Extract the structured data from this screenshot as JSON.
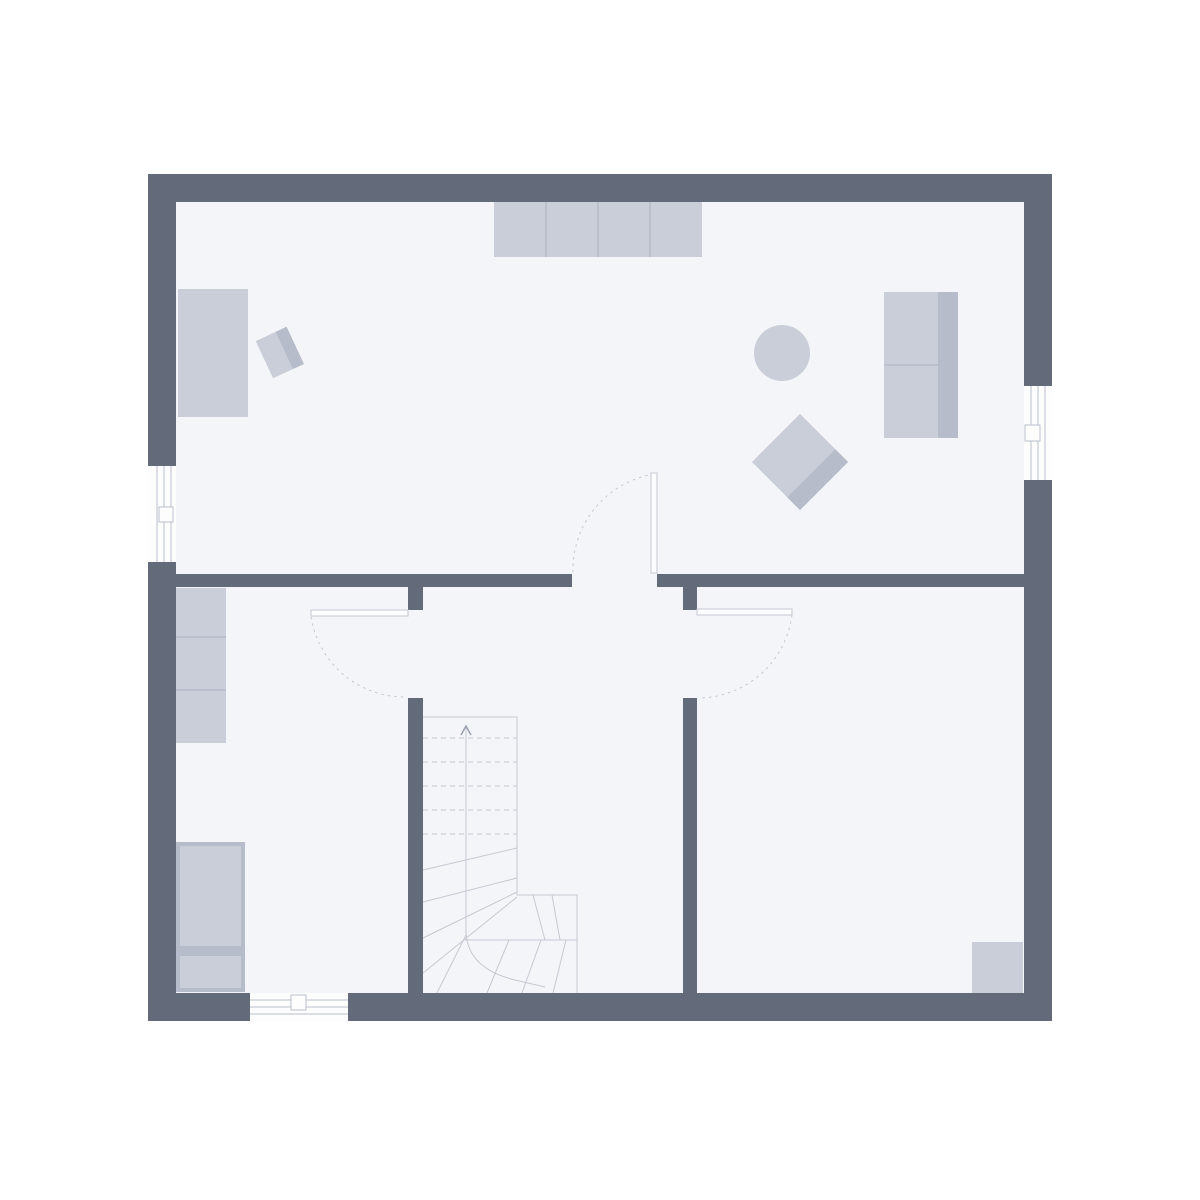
{
  "palette": {
    "background": "#ffffff",
    "wall": "#636a7a",
    "floor": "#f4f5f8",
    "furniture": "#c9ced8",
    "furniture_accent": "#b6bcc9",
    "thin_line": "#c5c9d2",
    "dash_line": "#c6c9d2",
    "window_fill": "#fdfdfe",
    "window_line": "#b9bec9",
    "door_leaf": "#fbfcfe",
    "walkline_arrow": "#9aa0ad"
  },
  "floorplan": {
    "type": "single-storey floor plan, no text labels",
    "exterior_wall_thickness_px": 28,
    "interior_wall_thickness_px": 14,
    "outer_bounds_px": {
      "x": 148,
      "y": 174,
      "width": 904,
      "height": 847
    },
    "rooms": [
      {
        "name": "living-area",
        "bounds": "top full width, y 202-574"
      },
      {
        "name": "room-bottom-left",
        "bounds": "x 176-408, y 587-993"
      },
      {
        "name": "hall-with-stairs",
        "bounds": "x 423-683, y 587-993"
      },
      {
        "name": "room-bottom-right",
        "bounds": "x 697-1024, y 587-993"
      }
    ],
    "windows": [
      {
        "name": "window-left-wall",
        "wall": "left",
        "span_px": "y 466-562"
      },
      {
        "name": "window-right-wall",
        "wall": "right",
        "span_px": "y 386-480"
      },
      {
        "name": "window-bottom-wall",
        "wall": "bottom",
        "span_px": "x 250-348"
      }
    ],
    "doors": [
      {
        "name": "door-living-room",
        "location": "center of interior horizontal wall",
        "swing": "into living area"
      },
      {
        "name": "door-room-left",
        "location": "left interior vertical wall",
        "swing": "into bottom-left room"
      },
      {
        "name": "door-room-right",
        "location": "right interior vertical wall",
        "swing": "into bottom-right room"
      }
    ],
    "staircase": {
      "name": "winder-staircase",
      "location": "hall, against left interior wall and bottom wall",
      "upper_flight_treads_dashed": 5,
      "winder_treads": 4,
      "landing_treads": 2,
      "lower_treads": 4,
      "walk_line_arrow": "up, pointing north"
    },
    "furniture": [
      {
        "name": "sideboard",
        "room": "living-area",
        "segments": 4
      },
      {
        "name": "desk",
        "room": "living-area"
      },
      {
        "name": "desk-chair",
        "room": "living-area",
        "rotation_deg": -25
      },
      {
        "name": "round-table",
        "room": "living-area",
        "radius_px": 28
      },
      {
        "name": "sofa",
        "room": "living-area",
        "back_side": "east"
      },
      {
        "name": "armchair",
        "room": "living-area",
        "rotation_deg": 45
      },
      {
        "name": "shelf-cabinet",
        "room": "room-bottom-left",
        "segments": 3
      },
      {
        "name": "wardrobe",
        "room": "room-bottom-left"
      },
      {
        "name": "corner-unit",
        "room": "room-bottom-right"
      }
    ]
  }
}
